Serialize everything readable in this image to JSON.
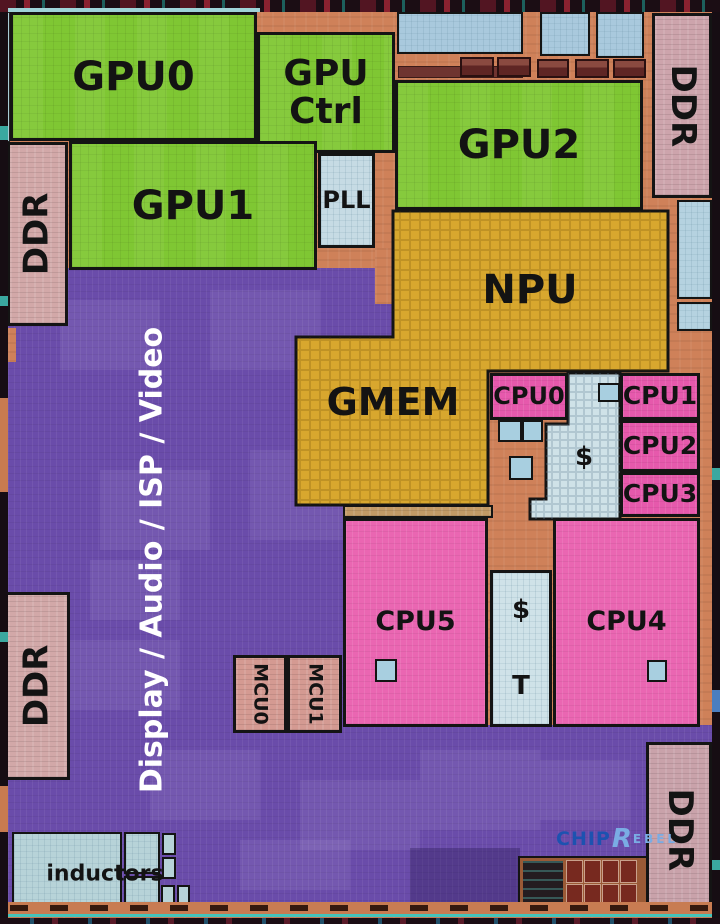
{
  "labels": {
    "gpu0": "GPU0",
    "gpu_ctrl_1": "GPU",
    "gpu_ctrl_2": "Ctrl",
    "gpu1": "GPU1",
    "gpu2": "GPU2",
    "pll": "PLL",
    "npu": "NPU",
    "gmem": "GMEM",
    "cpu0": "CPU0",
    "cpu1": "CPU1",
    "cpu2": "CPU2",
    "cpu3": "CPU3",
    "cpu4": "CPU4",
    "cpu5": "CPU5",
    "mcu0": "MCU0",
    "mcu1": "MCU1",
    "ddr_top_left": "DDR",
    "ddr_top_right": "DDR",
    "ddr_bottom_left": "DDR",
    "ddr_bottom_right": "DDR",
    "display_audio_isp_video": "Display / Audio / ISP / Video",
    "inductors": "inductors",
    "cache_cluster": "$",
    "cache_shared": "$",
    "cache_t": "T"
  },
  "watermark": {
    "part1": "CHIP",
    "part2": "R",
    "part3": "EBEL"
  },
  "colors": {
    "gpu_green": "#7fc733",
    "soc_purple": "#6a4caa",
    "npu_gold": "#d8a72e",
    "cpu_pink": "#e659ac",
    "ddr_mauve": "#cda4ac",
    "cache_blue": "#cfe2e8",
    "io_orange": "#cf8159",
    "watermark_blue": "#1d52b0",
    "watermark_light_blue": "#7aace4"
  }
}
